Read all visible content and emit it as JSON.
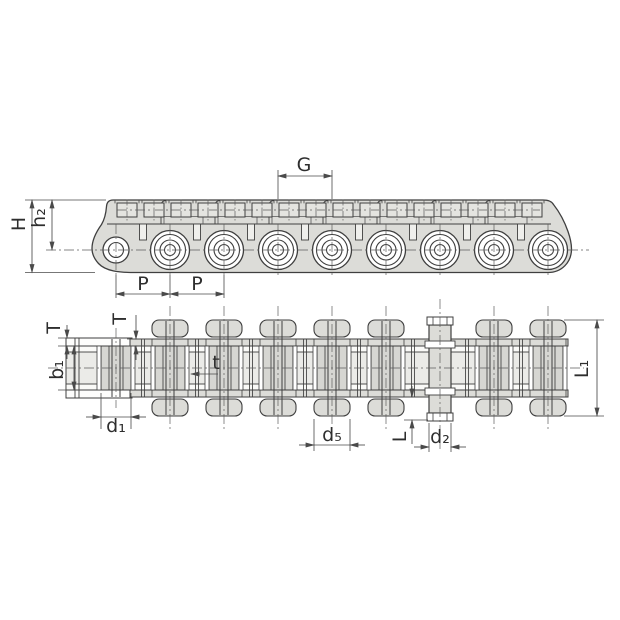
{
  "figure": {
    "title": "roller chain with attachments, two-view dimensioned drawing"
  },
  "labels": {
    "H": "H",
    "h2": "h₂",
    "G": "G",
    "P1": "P",
    "P2": "P",
    "T1": "T",
    "T2": "T",
    "b1": "b₁",
    "t": "t",
    "d1": "d₁",
    "d5": "d₅",
    "L": "L",
    "d2": "d₂",
    "L1": "L₁"
  },
  "colors": {
    "body": "#dcdcd8",
    "body_light": "#e6e6e2",
    "opening": "#ebebe8",
    "roller_fill": "#d6d6d2",
    "white": "#ffffff",
    "outline": "#3f3f3f",
    "dimension": "#4a4a4a",
    "centerline": "#5d5d5d"
  }
}
